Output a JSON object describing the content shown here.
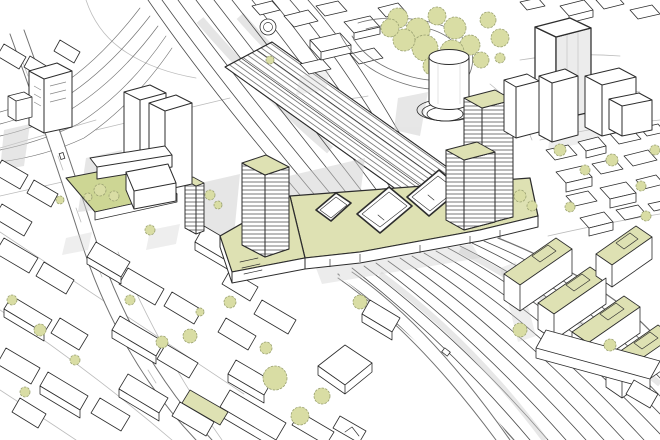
{
  "meta": {
    "title": "Aerial axonometric line illustration of a railway station district",
    "style": "hand-drawn architectural sketch, white paper with black line work and pale green accents"
  },
  "palette": {
    "paper": "#ffffff",
    "ink": "#2d2d2d",
    "ink_soft": "#707070",
    "street_gray": "#bcbcbc",
    "rail_gray": "#4a4a4a",
    "hatch": "#3c3c3c",
    "green_roof": "#dee1b3",
    "lawn": "#cdd694",
    "tree_fill": "#d9dda4",
    "tree_line": "#9aa171",
    "shadow": "#cfcfcf",
    "face_shade": "#ececec"
  },
  "scene": {
    "features": [
      {
        "name": "railway-corridor",
        "description": "diagonal railway corridor crossing the district"
      },
      {
        "name": "station-canopies",
        "description": "long hatched platform canopies of the station"
      },
      {
        "name": "green-deck",
        "description": "elevated green deck spanning the tracks",
        "courtyards": 3
      },
      {
        "name": "gasometer-tower",
        "description": "cylindrical tower with spiral ramp base"
      },
      {
        "name": "hatched-towers",
        "description": "high-rise slabs with horizontal banding and green roofs",
        "count": 3
      },
      {
        "name": "white-towers",
        "description": "plain white high-rise blocks",
        "count": 8
      },
      {
        "name": "park-trees",
        "description": "tree clusters in the park by the loop road"
      },
      {
        "name": "green-roof-housing",
        "description": "stepped housing rows with green roof terraces",
        "count": 5
      },
      {
        "name": "courtyard-garden-block",
        "description": "perimeter block with green courtyard garden"
      },
      {
        "name": "main-street",
        "description": "street running from top left to bottom centre"
      },
      {
        "name": "crossing-road",
        "description": "road bridging the tracks near the deck"
      },
      {
        "name": "city-fabric",
        "description": "low-rise urban fabric blocks"
      }
    ]
  }
}
